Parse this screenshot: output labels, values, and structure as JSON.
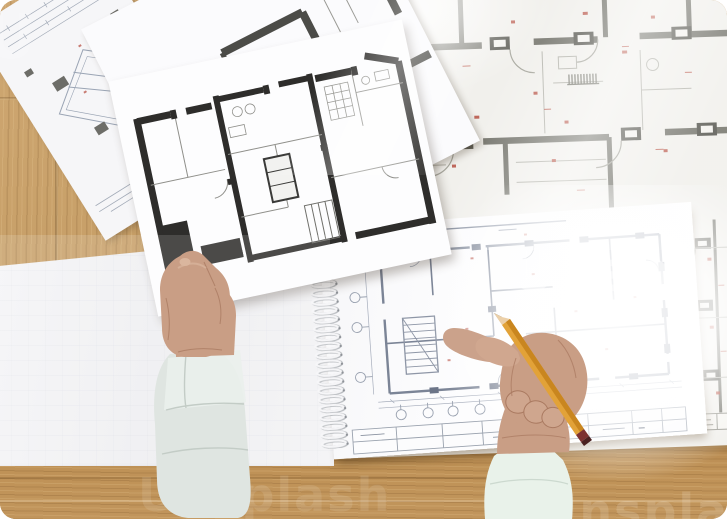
{
  "watermark": {
    "brand": "Unsplash",
    "center_fragment": "Unspl",
    "corner_fragment": "U"
  },
  "palette": {
    "wood": "#c69e66",
    "wood_bottom": "#bf9257",
    "blueprint_paper": "#f1f0ec",
    "paper_white": "#fdfdfe",
    "wall_dark": "#2e2d2b",
    "wall_mid": "#4c4c48",
    "wall_gray": "#77776f",
    "line_blue": "#8e96a6",
    "line_faint": "#b6bac4",
    "red_mark": "#b5483a",
    "skin": "#c99e85",
    "skin_shadow": "#aa7a61",
    "skin_light": "#dab69e",
    "sleeve_left": "#dfe5e1",
    "sleeve_right": "#e9f2ea",
    "pencil": "#e2a238",
    "pencil_wood": "#ecd0a9",
    "pencil_band": "#7c3030",
    "graphite": "#4b4b4b",
    "spiral": "#f5f5f7"
  }
}
